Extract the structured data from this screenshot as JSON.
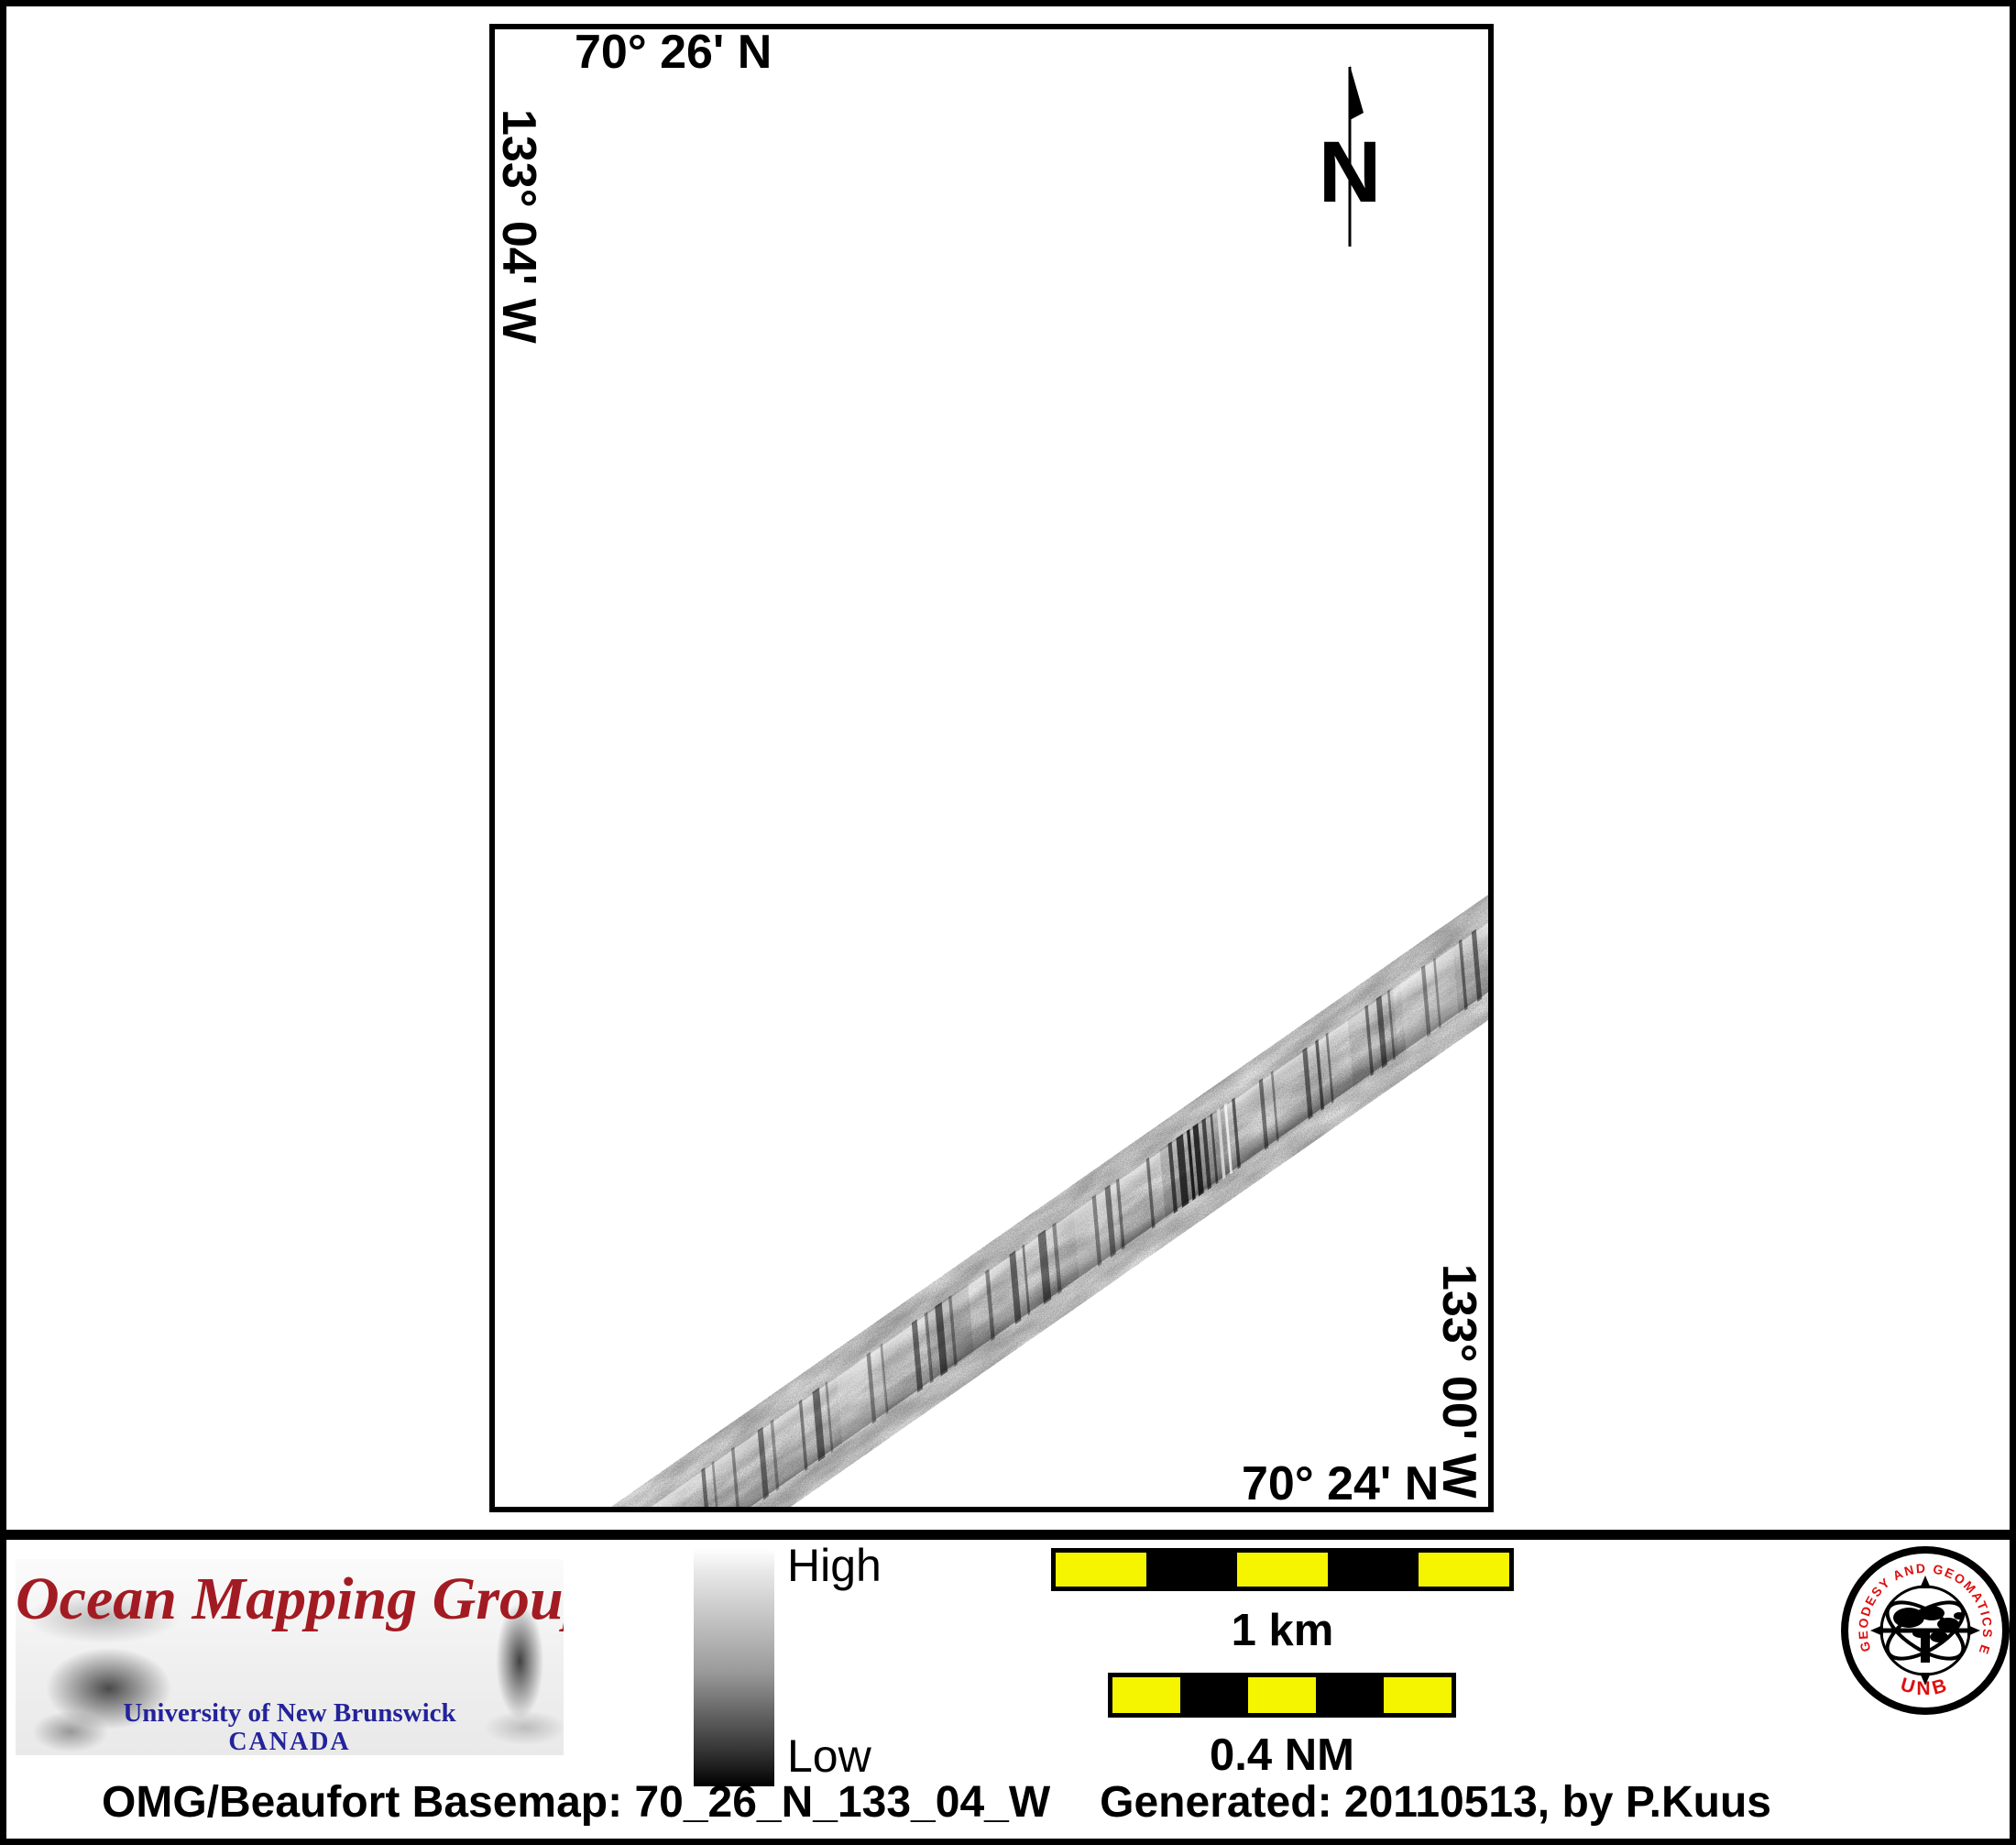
{
  "map": {
    "top_latitude": "70° 26' N",
    "bottom_latitude": "70° 24' N",
    "left_longitude": "133° 04' W",
    "right_longitude": "133° 00' W",
    "north_arrow_label": "N"
  },
  "colorbar": {
    "high_label": "High",
    "low_label": "Low"
  },
  "scale_bars": [
    {
      "label": "1 km"
    },
    {
      "label": "0.4 NM"
    }
  ],
  "banner": {
    "title": "Ocean Mapping Group",
    "institution": "University of New Brunswick",
    "country": "CANADA"
  },
  "seal": {
    "ring_text": "GEODESY AND GEOMATICS ENGINEERING",
    "bottom_text": "UNB"
  },
  "caption": {
    "basemap": "OMG/Beaufort Basemap: 70_26_N_133_04_W",
    "generated": "Generated: 20110513, by P.Kuus"
  },
  "colors": {
    "banner_title_red": "#a31b22",
    "unb_blue": "#23239a",
    "scale_yellow": "#f6f500",
    "seal_red": "#dd0f0f"
  }
}
